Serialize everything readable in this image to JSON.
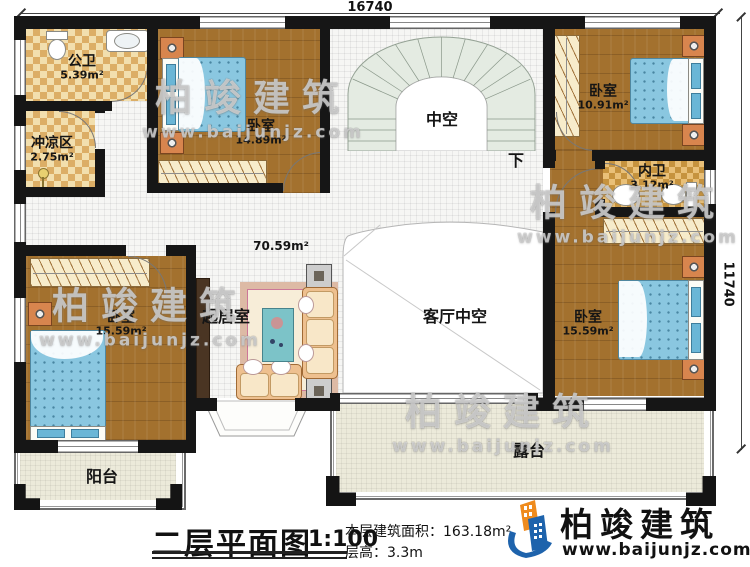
{
  "plan": {
    "dim_top": "16740",
    "dim_right": "11740",
    "hall_area": "70.59m²",
    "stair_down": "下",
    "rooms": {
      "gongwei": {
        "name": "公卫",
        "area": "5.39m²"
      },
      "chongliangqu": {
        "name": "冲凉区",
        "area": "2.75m²"
      },
      "bedroom_top": {
        "name": "卧室",
        "area": "14.89m²"
      },
      "zhongkong": {
        "name": "中空"
      },
      "bedroom_tr": {
        "name": "卧室",
        "area": "10.91m²"
      },
      "neiwei": {
        "name": "内卫",
        "area": "3.12m²"
      },
      "bedroom_right": {
        "name": "卧室",
        "area": "15.59m²"
      },
      "bedroom_left": {
        "name": "卧室",
        "area": "15.59m²"
      },
      "qijushi": {
        "name": "起居室"
      },
      "keting_void": {
        "name": "客厅中空"
      },
      "yangtai": {
        "name": "阳台"
      },
      "lutai": {
        "name": "露台"
      }
    }
  },
  "title_block": {
    "title": "二层平面图",
    "scale": "1:100",
    "area_label": "本层建筑面积：163.18m²",
    "height_label": "层高：3.3m"
  },
  "brand": {
    "name": "柏竣建筑",
    "site": "www.baijunjz.com",
    "blue": "#1e63ac",
    "orange": "#ef8b1d"
  },
  "watermark": {
    "name": "柏竣建筑",
    "site": "www.baijunjz.com"
  }
}
